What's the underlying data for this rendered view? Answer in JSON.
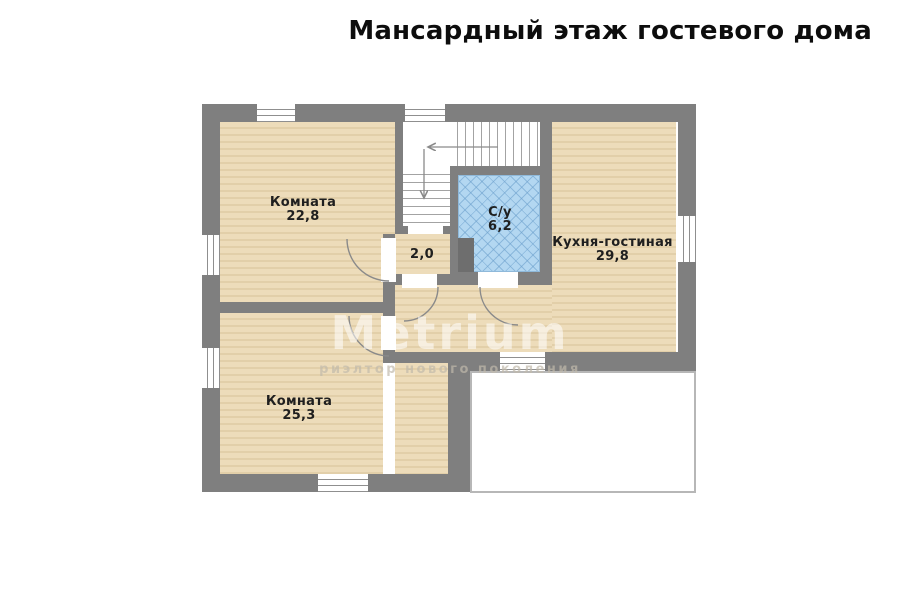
{
  "page": {
    "title": "Мансардный этаж гостевого дома"
  },
  "watermark": {
    "brand": "Metrium",
    "tagline": "риэлтор нового поколения"
  },
  "rooms": {
    "room_top_left": {
      "name": "Комната",
      "area": "22,8"
    },
    "room_bottom_left": {
      "name": "Комната",
      "area": "25,3"
    },
    "hall": {
      "area": "2,0"
    },
    "bathroom": {
      "name": "С/у",
      "area": "6,2"
    },
    "kitchen_living": {
      "name": "Кухня-гостиная",
      "area": "29,8"
    }
  },
  "colors": {
    "wall": "#7f7f7f",
    "floor": "#eddcba",
    "floor_line": "#e2cfa9",
    "tile": "#b3d7f1",
    "tile_line": "#8fb9da",
    "terrace_border": "#b7b7b7"
  }
}
